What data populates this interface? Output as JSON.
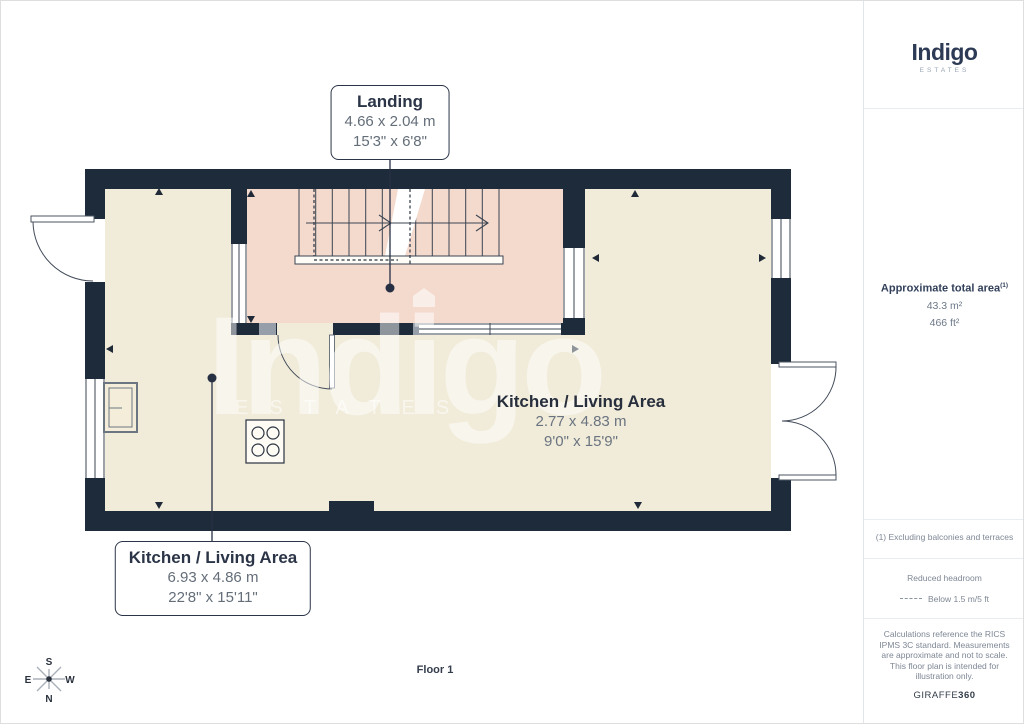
{
  "branding": {
    "logo": "Indigo",
    "logo_sub": "ESTATES",
    "watermark": "Indigo",
    "watermark_sub": "ESTATES"
  },
  "floorplan": {
    "floor_label": "Floor 1",
    "landing": {
      "name": "Landing",
      "metric": "4.66 x 2.04 m",
      "imperial": "15'3\" x 6'8\""
    },
    "kitchen_inline": {
      "name": "Kitchen / Living Area",
      "metric": "2.77 x 4.83 m",
      "imperial": "9'0\" x 15'9\""
    },
    "kitchen_callout": {
      "name": "Kitchen / Living Area",
      "metric": "6.93 x 4.86 m",
      "imperial": "22'8\" x 15'11\""
    },
    "compass": {
      "n": "N",
      "s": "S",
      "e": "E",
      "w": "W"
    }
  },
  "sidebar": {
    "area_title": "Approximate total area",
    "area_sup": "(1)",
    "area_metric": "43.3 m²",
    "area_imperial": "466 ft²",
    "footnote": "(1) Excluding balconies and terraces",
    "headroom_title": "Reduced headroom",
    "headroom_value": "Below 1.5 m/5 ft",
    "disclaimer": "Calculations reference the RICS IPMS 3C standard. Measurements are approximate and not to scale. This floor plan is intended for illustration only.",
    "brand": "GIRAFFE",
    "brand_bold": "360"
  },
  "colors": {
    "wall": "#1e2b3b",
    "floor": "#f1ebd9",
    "landing": "#f4d9cd",
    "accent_gray": "#959ea9",
    "text_dark": "#2b3547",
    "text_dim": "#646e79"
  }
}
